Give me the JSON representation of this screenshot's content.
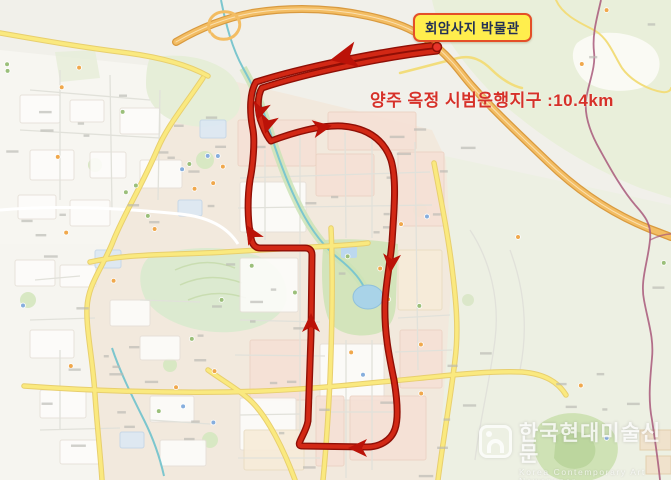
{
  "map": {
    "poi_label": "회암사지 박물관",
    "route_caption": "양주 옥정 시범운행지구 :10.4km",
    "route_distance": "10.4km",
    "colors": {
      "route": "#d22815",
      "route_dark": "#8f0f06",
      "poi_label_bg": "#ffee4d",
      "poi_label_border": "#e44f28",
      "caption_text": "#d63129",
      "boundary_line": "#a8587a",
      "highway": "#f3bd63",
      "major_road": "#fae97f"
    }
  },
  "watermark": {
    "title": "한국현대미술신문",
    "subtitle": "Korea Contemporary Art Newspaper"
  }
}
